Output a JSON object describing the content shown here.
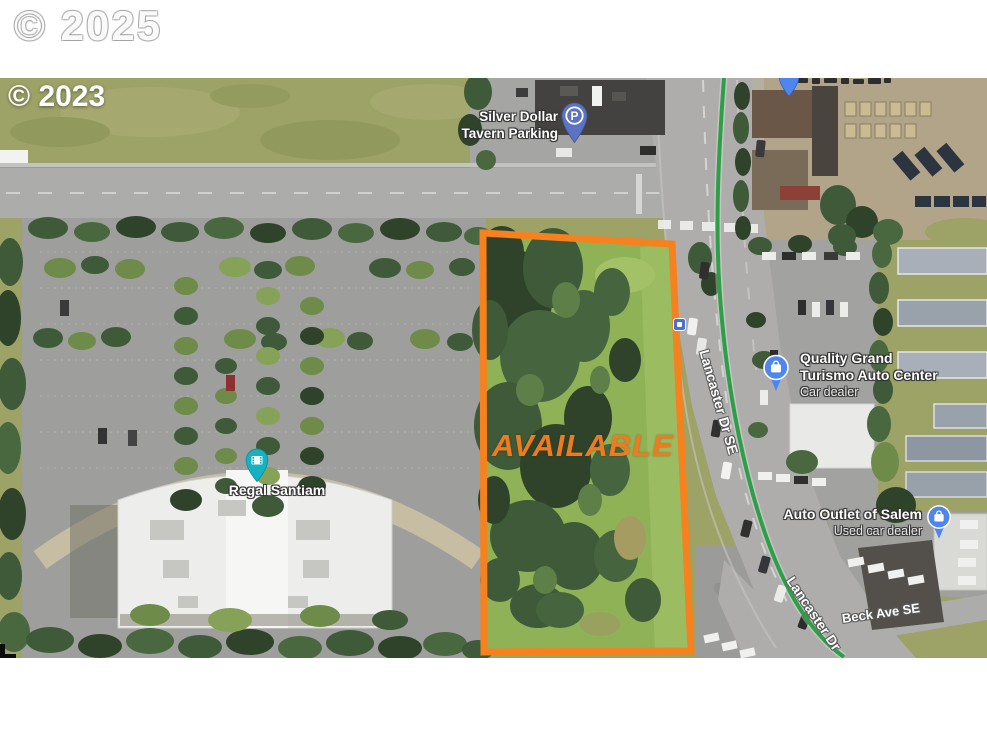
{
  "watermarks": {
    "page": "© 2025",
    "imagery": "© 2023"
  },
  "parcel": {
    "label": "AVAILABLE",
    "outline_color": "#F5821F"
  },
  "places": {
    "silver_dollar": {
      "line1": "Silver Dollar",
      "line2": "Tavern Parking"
    },
    "regal": {
      "name": "Regal Santiam"
    },
    "quality": {
      "line1": "Quality Grand",
      "line2": "Turismo Auto Center",
      "subtitle": "Car dealer"
    },
    "auto_outlet": {
      "name": "Auto Outlet of Salem",
      "subtitle": "Used car dealer"
    }
  },
  "roads": {
    "lancaster_full": "Lancaster Dr SE",
    "lancaster_short": "Lancaster Dr",
    "beck": "Beck Ave SE"
  },
  "icons": {
    "parking_glyph": "P"
  },
  "colors": {
    "parcel_outline": "#F5821F",
    "available_text": "#EE7B1F",
    "transit_line": "#2F9E48",
    "parking_pin": "#5C72C4",
    "theater_pin": "#14B2C4",
    "shopping_pin": "#4E86EE"
  }
}
